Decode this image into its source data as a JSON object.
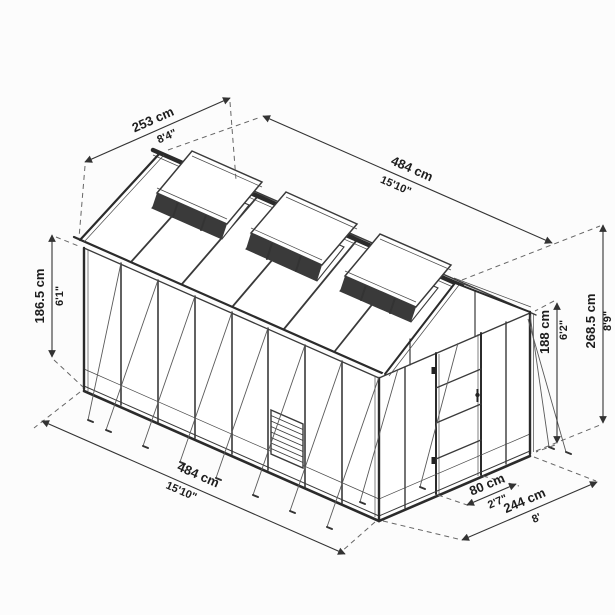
{
  "figure": {
    "background": "#fcfcfc",
    "line_color": "#3a3a3a",
    "dimension_text_color": "#1d1d1d",
    "dashed_line_color": "#666666"
  },
  "dims": {
    "roof_width": {
      "cm": "253 cm",
      "imperial": "8'4\""
    },
    "ridge_length": {
      "cm": "484 cm",
      "imperial": "15'10\""
    },
    "side_height": {
      "cm": "186.5 cm",
      "imperial": "6'1\""
    },
    "door_height": {
      "cm": "188 cm",
      "imperial": "6'2\""
    },
    "total_height": {
      "cm": "268.5 cm",
      "imperial": "8'9\""
    },
    "base_length": {
      "cm": "484 cm",
      "imperial": "15'10\""
    },
    "door_width": {
      "cm": "80 cm",
      "imperial": "2'7\""
    },
    "base_width": {
      "cm": "244 cm",
      "imperial": "8'"
    }
  }
}
